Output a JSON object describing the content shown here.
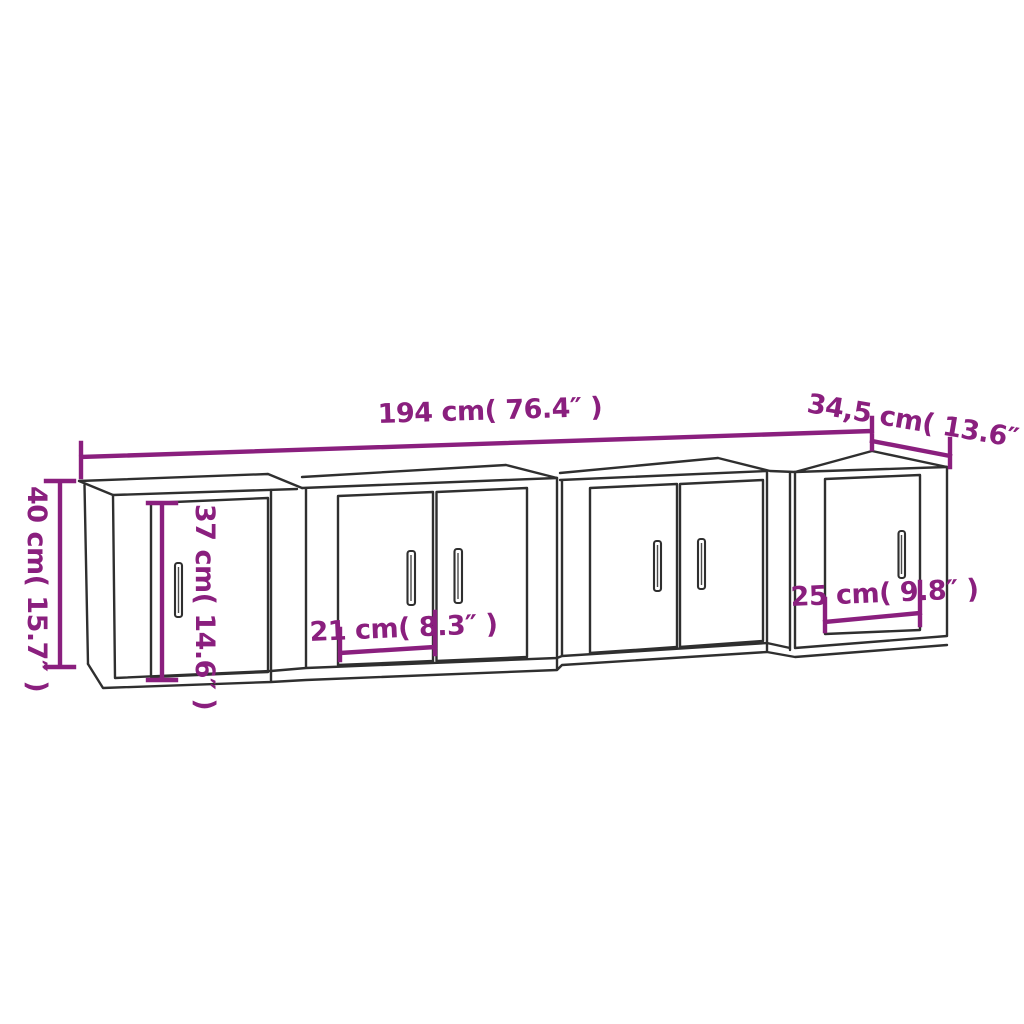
{
  "canvas": {
    "width": 1024,
    "height": 1024,
    "background": "#ffffff"
  },
  "style": {
    "outline_color": "#2f2f2f",
    "dimension_color": "#8a1f7e"
  },
  "diagram": {
    "kind": "furniture-dimension-line-drawing",
    "cabinet_count": 4,
    "labels": {
      "total_width": "194 cm( 76.4″ )",
      "depth": "34,5 cm( 13.6″ )",
      "height": "40 cm( 15.7″ )",
      "door_height": "37 cm( 14.6″ )",
      "middle_door_width": "21 cm( 8.3″ )",
      "right_door_width": "25 cm( 9.8″ )"
    },
    "measurements": [
      {
        "id": "total-width",
        "cm": "194",
        "inch": "76.4"
      },
      {
        "id": "depth",
        "cm": "34,5",
        "inch": "13.6"
      },
      {
        "id": "height",
        "cm": "40",
        "inch": "15.7"
      },
      {
        "id": "door-height",
        "cm": "37",
        "inch": "14.6"
      },
      {
        "id": "middle-door-width",
        "cm": "21",
        "inch": "8.3"
      },
      {
        "id": "right-door-width",
        "cm": "25",
        "inch": "9.8"
      }
    ]
  }
}
